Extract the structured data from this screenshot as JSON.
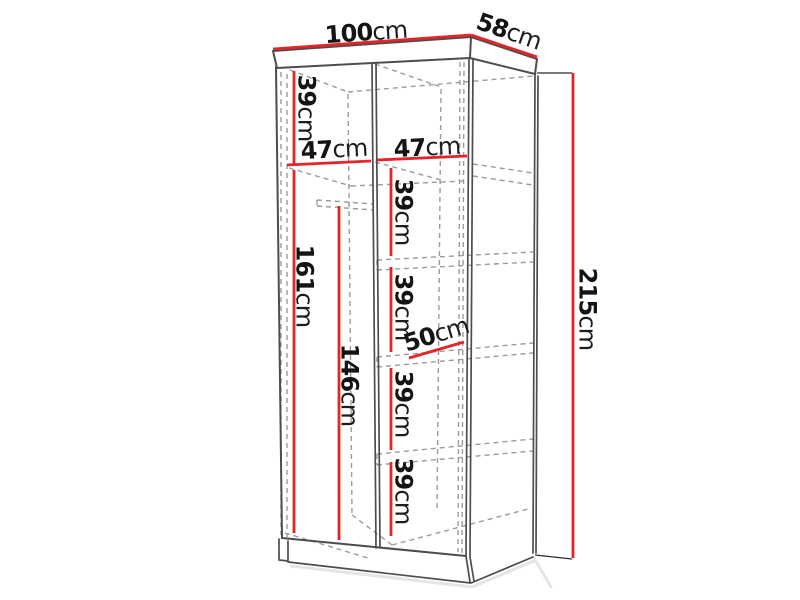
{
  "diagram": {
    "title": "wardrobe-dimension-diagram",
    "unit": "cm",
    "colors": {
      "dimension": "#e52428",
      "outline": "#4d4d4d",
      "dashed": "#9b9b9b",
      "text": "#141414"
    },
    "dimensions": {
      "width": {
        "value": "100",
        "unit": "cm"
      },
      "depth": {
        "value": "58",
        "unit": "cm"
      },
      "height": {
        "value": "215",
        "unit": "cm"
      },
      "top_shelf_height": {
        "value": "39",
        "unit": "cm"
      },
      "left_width": {
        "value": "47",
        "unit": "cm"
      },
      "right_width": {
        "value": "47",
        "unit": "cm"
      },
      "left_height": {
        "value": "161",
        "unit": "cm"
      },
      "rod_height": {
        "value": "146",
        "unit": "cm"
      },
      "right_shelf_1": {
        "value": "39",
        "unit": "cm"
      },
      "right_shelf_2": {
        "value": "39",
        "unit": "cm"
      },
      "right_shelf_3": {
        "value": "39",
        "unit": "cm"
      },
      "right_shelf_4": {
        "value": "39",
        "unit": "cm"
      },
      "shelf_depth": {
        "value": "50",
        "unit": "cm"
      }
    }
  }
}
